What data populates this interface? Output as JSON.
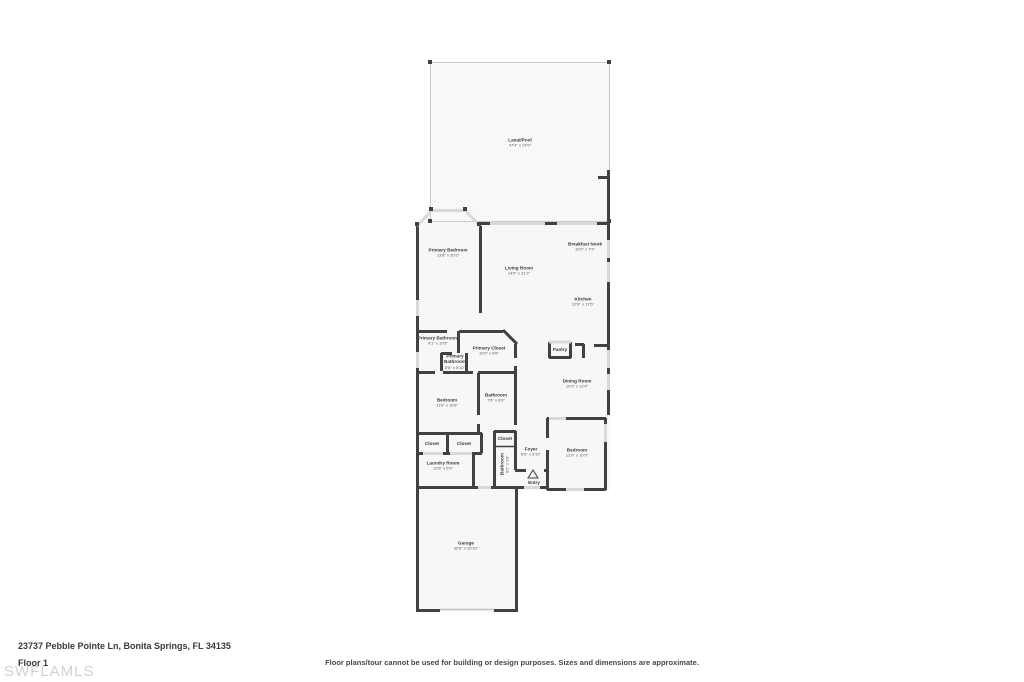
{
  "footer": {
    "address": "23737 Pebble Pointe Ln, Bonita Springs, FL 34135",
    "floor_label": "Floor 1",
    "watermark": "SWFLAMLS",
    "disclaimer": "Floor plans/tour cannot be used for building or design purposes. Sizes and dimensions are approximate."
  },
  "colors": {
    "wall": "#414141",
    "window": "#d9d9d9",
    "room_fill": "#f7f7f7",
    "pool_outline": "#c9c9c9",
    "label_text": "#3a3a3a",
    "watermark": "#d2d2d2"
  },
  "rooms": [
    {
      "id": "lanai-pool",
      "name": "Lanai/Pool",
      "dims": "47'4\" x 24'9\""
    },
    {
      "id": "primary-bedroom",
      "name": "Primary Bedroom",
      "dims": "13'8\" x 20'3\""
    },
    {
      "id": "living-room",
      "name": "Living Room",
      "dims": "14'9\" x 21'2\""
    },
    {
      "id": "breakfast-nook",
      "name": "Breakfast Nook",
      "dims": "10'9\" x 7'9\""
    },
    {
      "id": "kitchen",
      "name": "Kitchen",
      "dims": "10'9\" x 17'6\""
    },
    {
      "id": "primary-bathroom",
      "name": "Primary Bathroom",
      "dims": "9'1\" x 10'5\""
    },
    {
      "id": "primary-closet",
      "name": "Primary Closet",
      "dims": "10'0\" x 6'6\""
    },
    {
      "id": "primary-bathroom-2",
      "name": "Primary Bathroom",
      "dims": "5'8\" x 5'10\""
    },
    {
      "id": "pantry",
      "name": "Pantry",
      "dims": ""
    },
    {
      "id": "dining-room",
      "name": "Dining Room",
      "dims": "10'3\" x 12'4\""
    },
    {
      "id": "bedroom-left",
      "name": "Bedroom",
      "dims": "11'8\" x 10'8\""
    },
    {
      "id": "bathroom",
      "name": "Bathroom",
      "dims": "7'6\" x 6'6\""
    },
    {
      "id": "closet-a",
      "name": "Closet",
      "dims": ""
    },
    {
      "id": "closet-b",
      "name": "Closet",
      "dims": ""
    },
    {
      "id": "closet-c",
      "name": "Closet",
      "dims": ""
    },
    {
      "id": "foyer",
      "name": "Foyer",
      "dims": "6'5\" x 6'10\""
    },
    {
      "id": "hall-bathroom",
      "name": "Bathroom",
      "dims": "8'2\" x 3'6\""
    },
    {
      "id": "bedroom-right",
      "name": "Bedroom",
      "dims": "12'0\" x 10'9\""
    },
    {
      "id": "laundry-room",
      "name": "Laundry Room",
      "dims": "10'5\" x 6'9\""
    },
    {
      "id": "entry",
      "name": "Entry",
      "dims": ""
    },
    {
      "id": "garage",
      "name": "Garage",
      "dims": "30'5\" x 20'10\""
    }
  ]
}
